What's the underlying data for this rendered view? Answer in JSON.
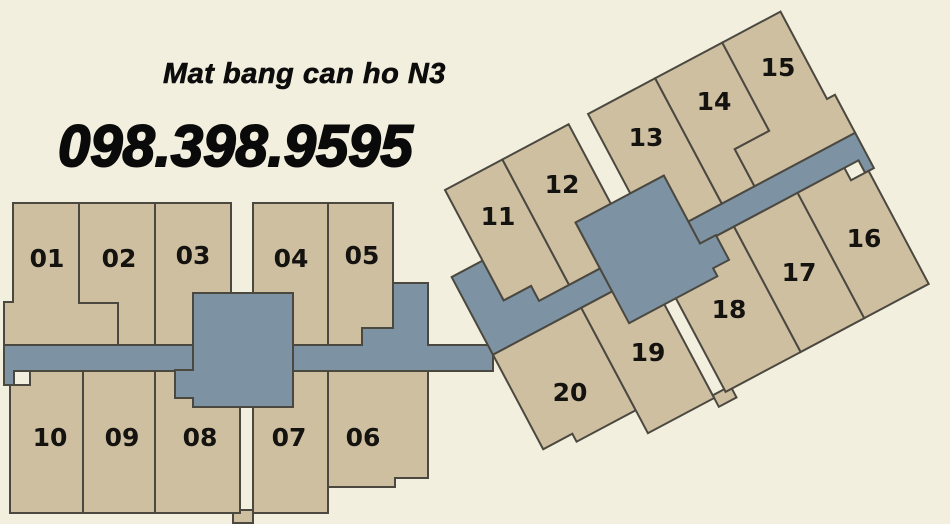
{
  "header": {
    "title": "Mat bang can ho N3",
    "phone": "098.398.9595"
  },
  "plan": {
    "name": "floor-plan-n3",
    "left_wing_top_row": [
      "01",
      "02",
      "03",
      "04",
      "05"
    ],
    "left_wing_bottom_row": [
      "10",
      "09",
      "08",
      "07",
      "06"
    ],
    "right_wing_top_row": [
      "11",
      "12",
      "13",
      "14",
      "15"
    ],
    "right_wing_bottom_row": [
      "20",
      "19",
      "18",
      "17",
      "16"
    ]
  },
  "units": [
    {
      "label": "01"
    },
    {
      "label": "02"
    },
    {
      "label": "03"
    },
    {
      "label": "04"
    },
    {
      "label": "05"
    },
    {
      "label": "06"
    },
    {
      "label": "07"
    },
    {
      "label": "08"
    },
    {
      "label": "09"
    },
    {
      "label": "10"
    },
    {
      "label": "11"
    },
    {
      "label": "12"
    },
    {
      "label": "13"
    },
    {
      "label": "14"
    },
    {
      "label": "15"
    },
    {
      "label": "16"
    },
    {
      "label": "17"
    },
    {
      "label": "18"
    },
    {
      "label": "19"
    },
    {
      "label": "20"
    }
  ],
  "palette": {
    "background": "#f2efde",
    "apartment_fill": "#cebfa1",
    "corridor_fill": "#7d92a3",
    "outline": "#4b4840",
    "text": "#0c0c0c"
  }
}
